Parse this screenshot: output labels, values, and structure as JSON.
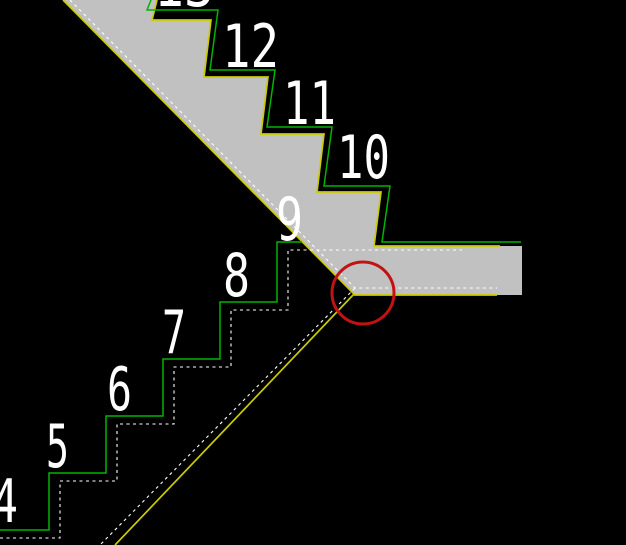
{
  "canvas": {
    "width": 626,
    "height": 545,
    "background": "#000000"
  },
  "colors": {
    "concrete_fill": "#c1c1c1",
    "structure_line": "#cbcb00",
    "finish_line": "#00b400",
    "hidden_line": "#ffffff",
    "label_text": "#ffffff",
    "marker": "#c21212"
  },
  "style": {
    "structure_width": 1.7,
    "finish_width": 1.5,
    "hidden_width": 1.1,
    "hidden_dash": "3 3.5",
    "marker_width": 3,
    "label_font_size": 60
  },
  "step_labels": [
    {
      "label": "13",
      "x": 154,
      "baseline": 6,
      "width": 60
    },
    {
      "label": "12",
      "x": 222,
      "baseline": 67,
      "width": 57
    },
    {
      "label": "11",
      "x": 283,
      "baseline": 124,
      "width": 53
    },
    {
      "label": "10",
      "x": 337,
      "baseline": 178,
      "width": 53
    },
    {
      "label": "9",
      "x": 276,
      "baseline": 240,
      "width": 27
    },
    {
      "label": "8",
      "x": 223,
      "baseline": 296,
      "width": 27
    },
    {
      "label": "7",
      "x": 162,
      "baseline": 353,
      "width": 24
    },
    {
      "label": "6",
      "x": 107,
      "baseline": 410,
      "width": 25
    },
    {
      "label": "5",
      "x": 46,
      "baseline": 467,
      "width": 23
    },
    {
      "label": "4",
      "x": -8,
      "baseline": 522,
      "width": 26
    }
  ],
  "geometry": {
    "concrete_polygon": "63,0 157,0 152,20 211,20 204,77 268,77 261,134 324,134 317,192 381,192 374,246 522,246 522,295 354,295",
    "structure_paths": [
      "M157,0 L152,20 L211,20 L204,77 L268,77 L261,134 L324,134 L317,192 L381,192 L374,246 L500,246",
      "M63,0 L354,294 L115,545",
      "M354,295 L497,295"
    ],
    "finish_paths": [
      "M151,0 L147,10 L218,10 L210,70 L275,70 L267,127 L332,127 L324,186 L390,186 L382,242 L521,242",
      "M0,530 L49,530 L49,473 L106,473 L106,416 L163,416 L163,359 L220,359 L220,302 L277,302 L277,242 L302,242"
    ],
    "hidden_paths": [
      "M70,0 L355,288 L497,288",
      "M355,288 L100,545",
      "M0,538 L60,538 L60,481 L117,481 L117,424 L174,424 L174,367 L231,367 L231,310 L288,310 L288,250 L462,250"
    ]
  },
  "marker_circle": {
    "cx": 363,
    "cy": 293,
    "r": 31
  }
}
